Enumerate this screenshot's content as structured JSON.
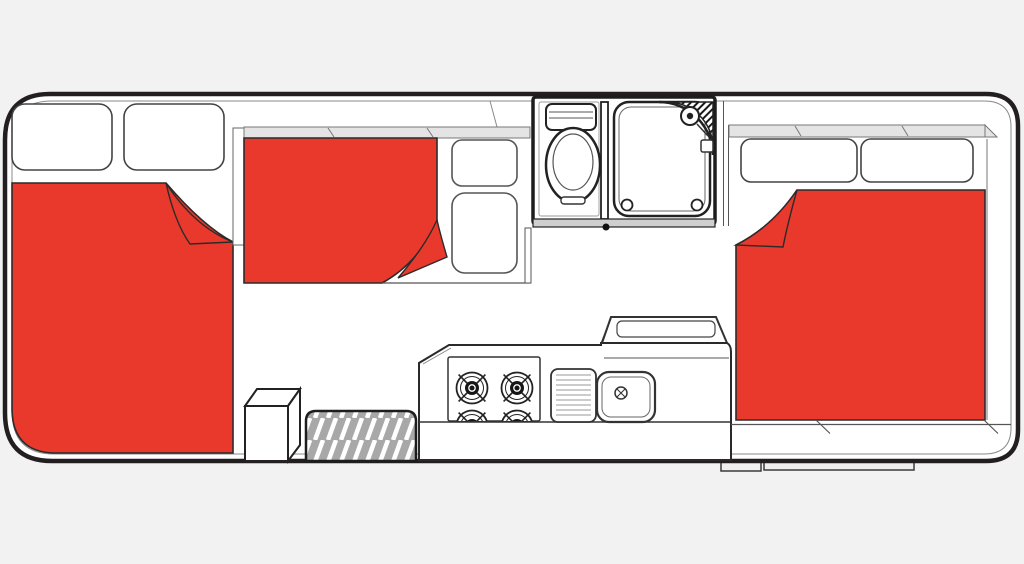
{
  "canvas": {
    "width": 1024,
    "height": 564
  },
  "colors": {
    "background": "#f2f2f2",
    "interior_white": "#ffffff",
    "outline": "#231f20",
    "bed_red": "#e8392c",
    "shelf_gray": "#e4e4e4",
    "mat_gray": "#a8a8a8",
    "wall_band_gray": "#cfcfcf",
    "step_gray": "#efefef",
    "burner_black": "#161616"
  },
  "floorplan": {
    "type": "motorhome-floorplan-top-view",
    "regions": {
      "front_bed": {
        "name": "front-double-bed",
        "pillow_count": 2,
        "blanket_folded_corner": "top-right"
      },
      "dinette": {
        "name": "convertible-dinette-bed",
        "seat_cushion_count": 2,
        "blanket_folded_corner": "bottom-right"
      },
      "bathroom": {
        "fixtures": [
          "toilet",
          "shower-cubicle",
          "corner-shower-head",
          "soap-shelf"
        ]
      },
      "kitchen": {
        "burner_count": 4,
        "fixtures": [
          "stove",
          "drainer",
          "sink",
          "bench-lid"
        ]
      },
      "rear_bed": {
        "name": "rear-double-bed",
        "pillow_count": 2,
        "blanket_folded_corner": "top-left"
      },
      "entry": {
        "fixtures": [
          "step-box",
          "door-mat"
        ],
        "exterior_steps": 2
      }
    }
  }
}
